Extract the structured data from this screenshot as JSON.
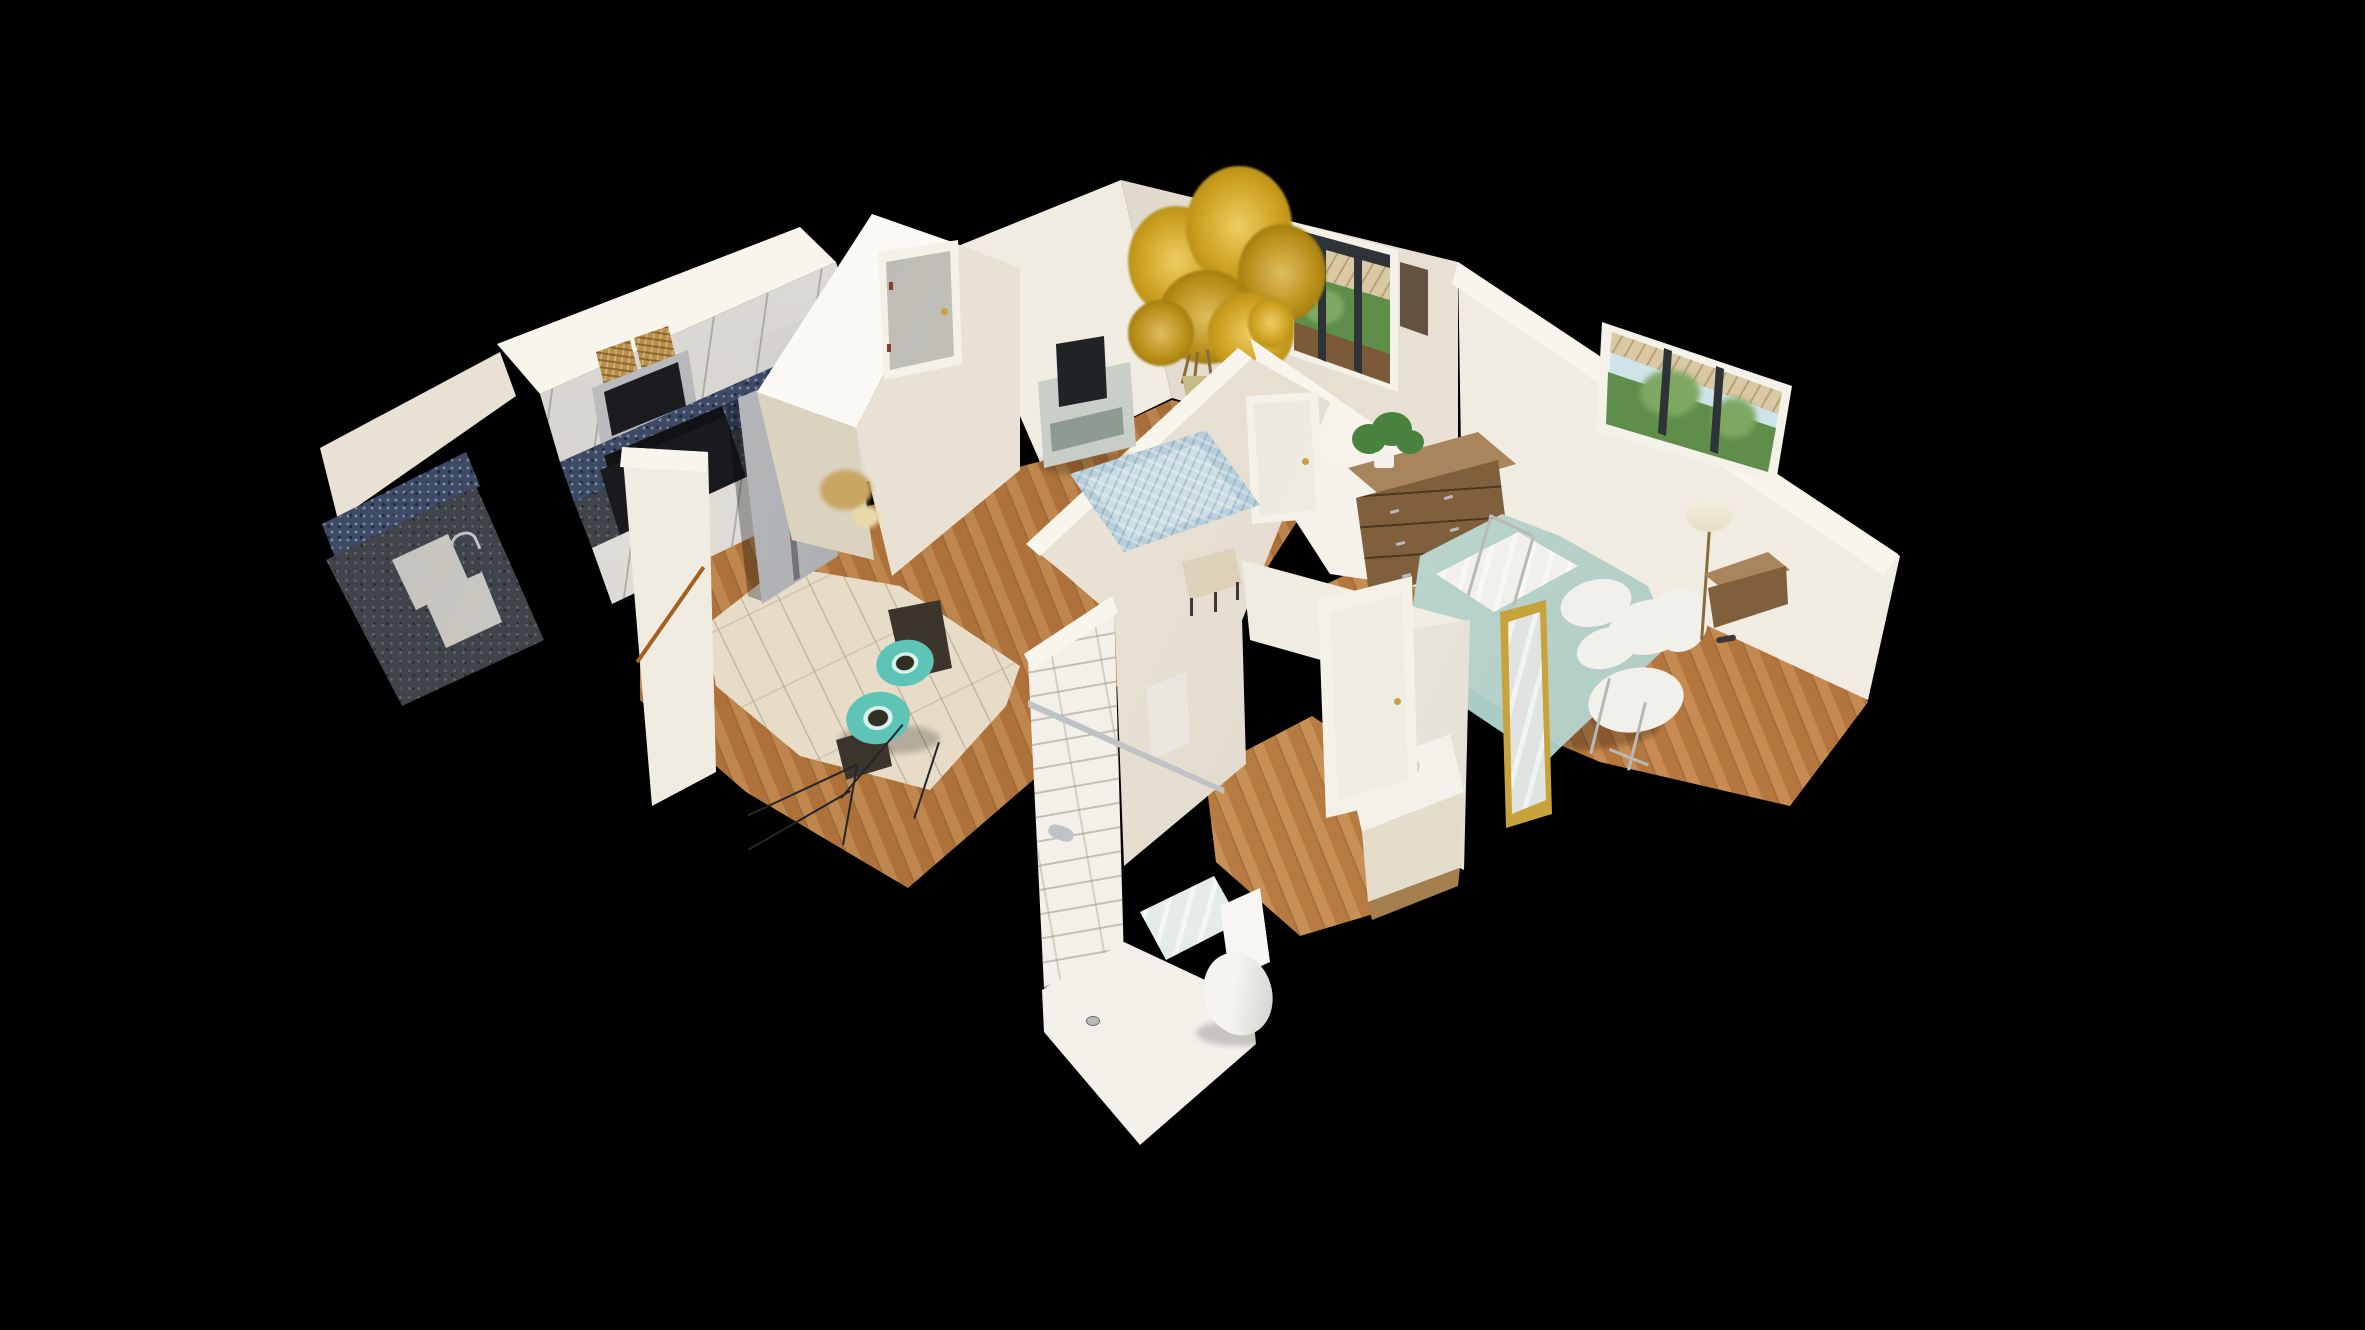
{
  "app": {
    "name": "3D Home Tour - Dollhouse View",
    "view_mode": "dollhouse",
    "background": "#000000"
  },
  "palette": {
    "bg": "#000000",
    "wallBright": "#f8f5ec",
    "wallLight": "#f1ece1",
    "wallMid": "#e9e2d4",
    "wallShade": "#dbd2c0",
    "floorWood": "#b5793f",
    "floorWoodBed": "#bf8045",
    "floorWoodBath": "#c08449",
    "floorTile": "#e7dcc8",
    "cabinetFace": "#dcd9d2",
    "cabinetLower": "#e6e3dc",
    "cabinetOverFridge": "#d6d3cc",
    "stainless": "#b9bcbf",
    "applianceDark": "#1a1c1f",
    "applianceDarker": "#101214",
    "backsplash": "#3d4a66",
    "granite": "#3f444a",
    "sinkWhite": "#d8d6cf",
    "basket": "#b98f4e",
    "doorGray": "#c9c7c0",
    "doorWhite": "#efece3",
    "frameWhite": "#f4f1e9",
    "treeYellow": "#e2b322",
    "treeYellowDeep": "#c79a18",
    "trunkBrown": "#8a6b3a",
    "potGold": "#a8913f",
    "consoleSage": "#a9b2a9",
    "consoleShelf": "#8f9a90",
    "tvDark": "#212427",
    "rugBlue": "#b7cfda",
    "rugInner": "#cddee5",
    "curtainBrown": "#63523f",
    "skyView": "#cfe4ea",
    "greenView": "#5f8e4b",
    "greenViewLight": "#7fa862",
    "porchTan": "#d9c8a4",
    "railBrown": "#7a5a38",
    "mullionDark": "#2e3337",
    "bedSeafoam": "#bfdbd3",
    "bedSeafoamDeep": "#a9ccc4",
    "linenWhite": "#f1f0ea",
    "dresserWood": "#7f5f3c",
    "dresserTop": "#a8855c",
    "plantGreen": "#49823f",
    "tileWhite": "#f3f0ea",
    "chrome": "#c0c3c5",
    "toiletWhite": "#f6f4ef",
    "matBlue": "#e3ecea",
    "vanityTop": "#f3f1ea",
    "vanityBase": "#e5ddcb",
    "vanityWood": "#a57f4e",
    "mirrorGold": "#c8a23a",
    "mirrorGlass": "#dfe4e0",
    "tealDrum": "#5fc4b8",
    "metalFrame": "#b9b9b9",
    "benchTan": "#cfbd9a",
    "lampShade": "#e8ddc2",
    "scanTan": "#c9a662",
    "scanTanLight": "#e8d9a8",
    "sculptureDark": "#3b352b",
    "wireDark": "#22262a",
    "broomBrown": "#a35f1f",
    "towelWhite": "#e9e7e0",
    "hingeRed": "#8a3c2e",
    "legDark": "#3a3a3a"
  },
  "scene": {
    "rooms": [
      {
        "name": "kitchen",
        "objects": [
          "upper-cabinets",
          "wicker-baskets",
          "microwave",
          "range",
          "refrigerator",
          "granite-countertop",
          "double-basin-sink",
          "mosaic-backsplash",
          "tile-floor"
        ]
      },
      {
        "name": "living-room",
        "objects": [
          "yellow-tree",
          "tree-pot",
          "tv",
          "tv-console",
          "blue-area-rug",
          "sliding-glass-door",
          "curtain",
          "drum-stools",
          "wire-table",
          "bench",
          "hardwood-floor"
        ]
      },
      {
        "name": "entry",
        "objects": [
          "front-door",
          "partition-wall",
          "broom"
        ]
      },
      {
        "name": "hallway",
        "objects": [
          "closet-door"
        ]
      },
      {
        "name": "bathroom",
        "objects": [
          "subway-tile-shower",
          "shower-rod",
          "shower-head",
          "shower-pan",
          "bath-mat",
          "toilet",
          "vanity-sink",
          "bathroom-door",
          "leaning-mirror",
          "towel"
        ]
      },
      {
        "name": "bedroom",
        "objects": [
          "bed",
          "seafoam-comforter",
          "pillows",
          "metal-bed-frame",
          "dresser",
          "dresser-plant",
          "window",
          "floor-lamp",
          "nightstand",
          "hardwood-floor"
        ]
      }
    ]
  }
}
